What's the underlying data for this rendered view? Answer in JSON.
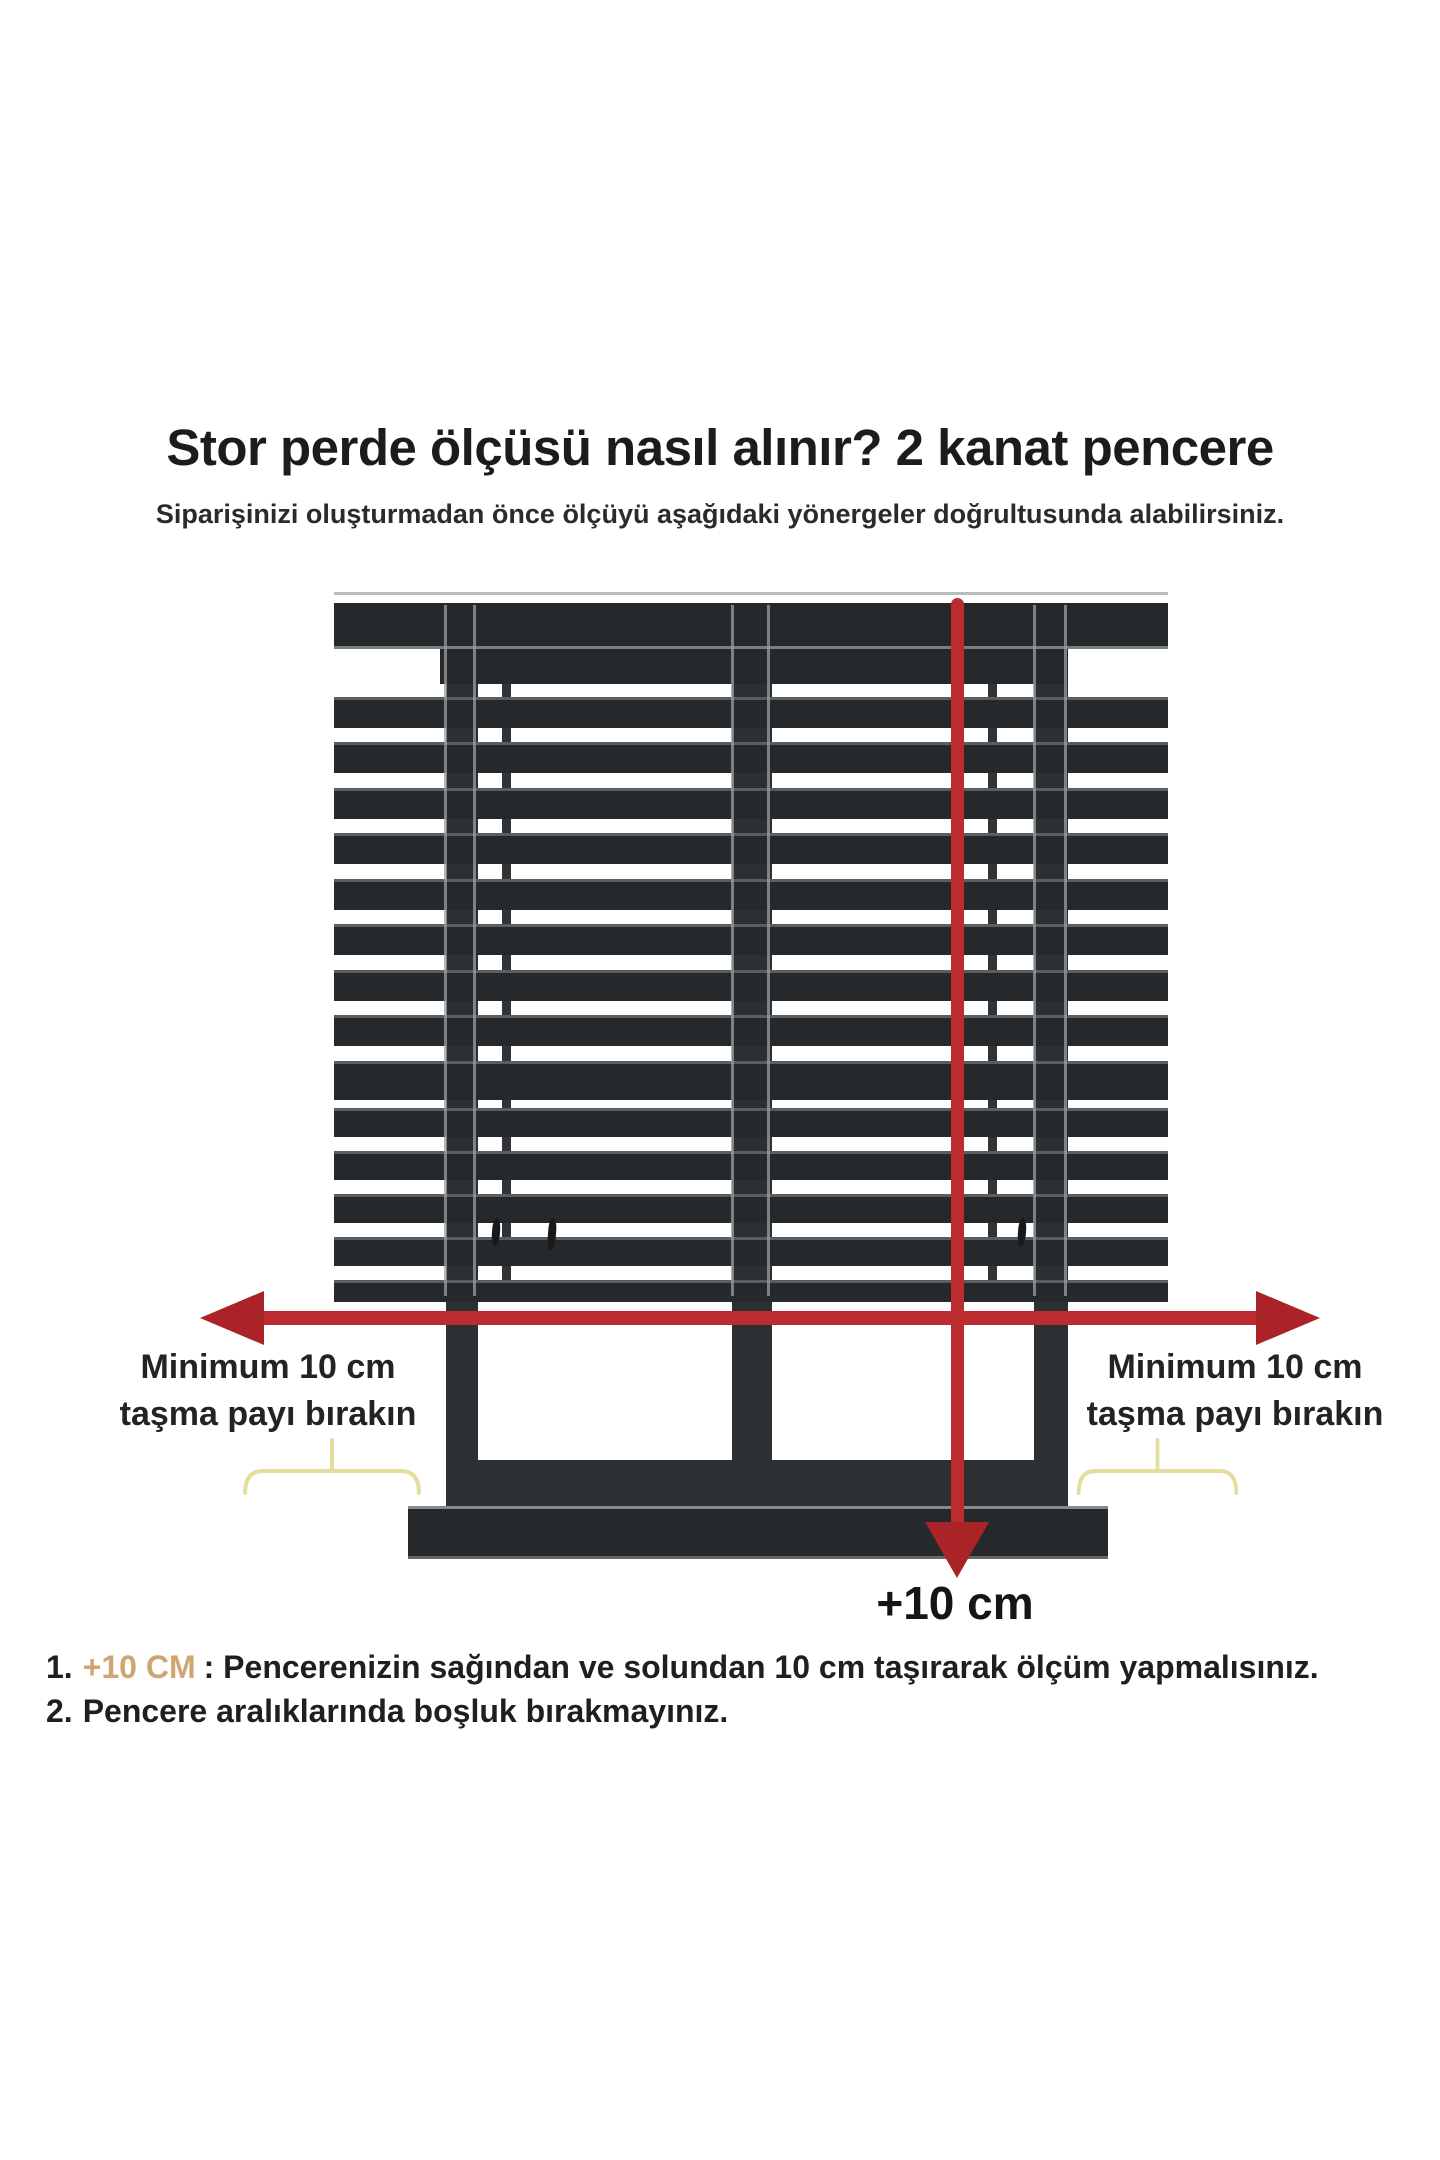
{
  "colors": {
    "arrow_red": "#bb2b30",
    "arrow_red_dark": "#a92327",
    "frame_dark": "#26292b",
    "frame_mid": "#2c3032",
    "edge_light": "#9aa0a3",
    "brace_yellow": "#e4dd9c",
    "highlight_tan": "#cfa673",
    "text_dark": "#202020"
  },
  "icons": {
    "width_arrow": "double-headed-horizontal-arrow",
    "height_arrow": "vertical-down-arrow",
    "overhang_brace": "upward-curly-brace"
  },
  "header": {
    "title": "Stor perde ölçüsü nasıl alınır? 2 kanat pencere",
    "subtitle": "Siparişinizi oluşturmadan önce ölçüyü aşağıdaki yönergeler doğrultusunda alabilirsiniz."
  },
  "diagram": {
    "left_label": {
      "line1": "Minimum 10 cm",
      "line2": "taşma payı bırakın"
    },
    "right_label": {
      "line1": "Minimum 10 cm",
      "line2": "taşma payı bırakın"
    },
    "bottom_measure_label": "+10 cm"
  },
  "instructions": {
    "item1": {
      "number": "1.",
      "highlight": "+10 CM",
      "text": ": Pencerenizin sağından ve solundan 10 cm taşırarak ölçüm yapmalısınız."
    },
    "item2": {
      "number": "2.",
      "text": "Pencere aralıklarında boşluk bırakmayınız."
    }
  }
}
